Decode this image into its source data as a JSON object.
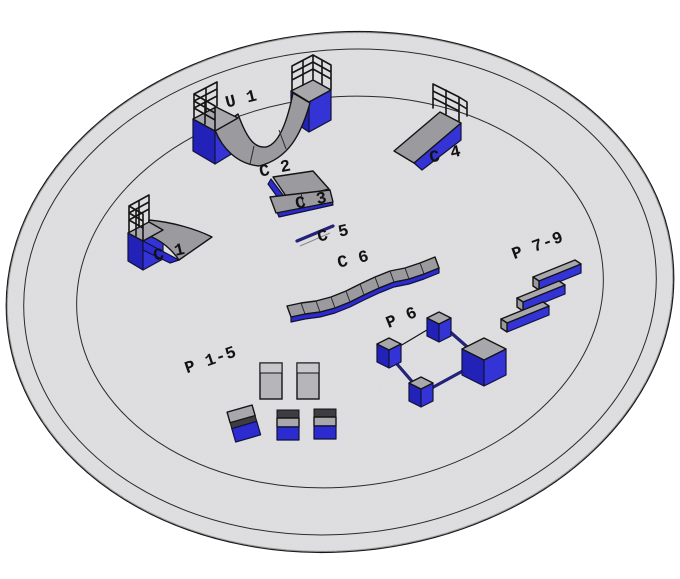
{
  "scene": {
    "background": "#ffffff",
    "ground_fill": "#d3d3d5",
    "ring_color": "#2a2a2e",
    "outline_color": "#141414",
    "obstacle_blue": "#2b2bd0",
    "obstacle_blue_dark": "#2222b8",
    "obstacle_blue_bright": "#3434d6",
    "obstacle_gray": "#9b9b9f",
    "rail_color": "#23237a",
    "label_color": "#121212"
  },
  "obstacles": [
    {
      "id": "u1",
      "label": "U 1",
      "kind": "halfpipe"
    },
    {
      "id": "c1",
      "label": "C 1",
      "kind": "quarterpipe"
    },
    {
      "id": "c2",
      "label": "C 2",
      "kind": "kicker-ramp"
    },
    {
      "id": "c3",
      "label": "C 3",
      "kind": "kicker-ramp"
    },
    {
      "id": "c4",
      "label": "C 4",
      "kind": "bank-ramp"
    },
    {
      "id": "c5",
      "label": "C 5",
      "kind": "flat-rail"
    },
    {
      "id": "c6",
      "label": "C 6",
      "kind": "wave-ledge"
    },
    {
      "id": "p15",
      "label": "P 1-5",
      "kind": "boxes"
    },
    {
      "id": "p6",
      "label": "P 6",
      "kind": "block-rail-combo"
    },
    {
      "id": "p79",
      "label": "P 7-9",
      "kind": "grind-ledges"
    }
  ]
}
